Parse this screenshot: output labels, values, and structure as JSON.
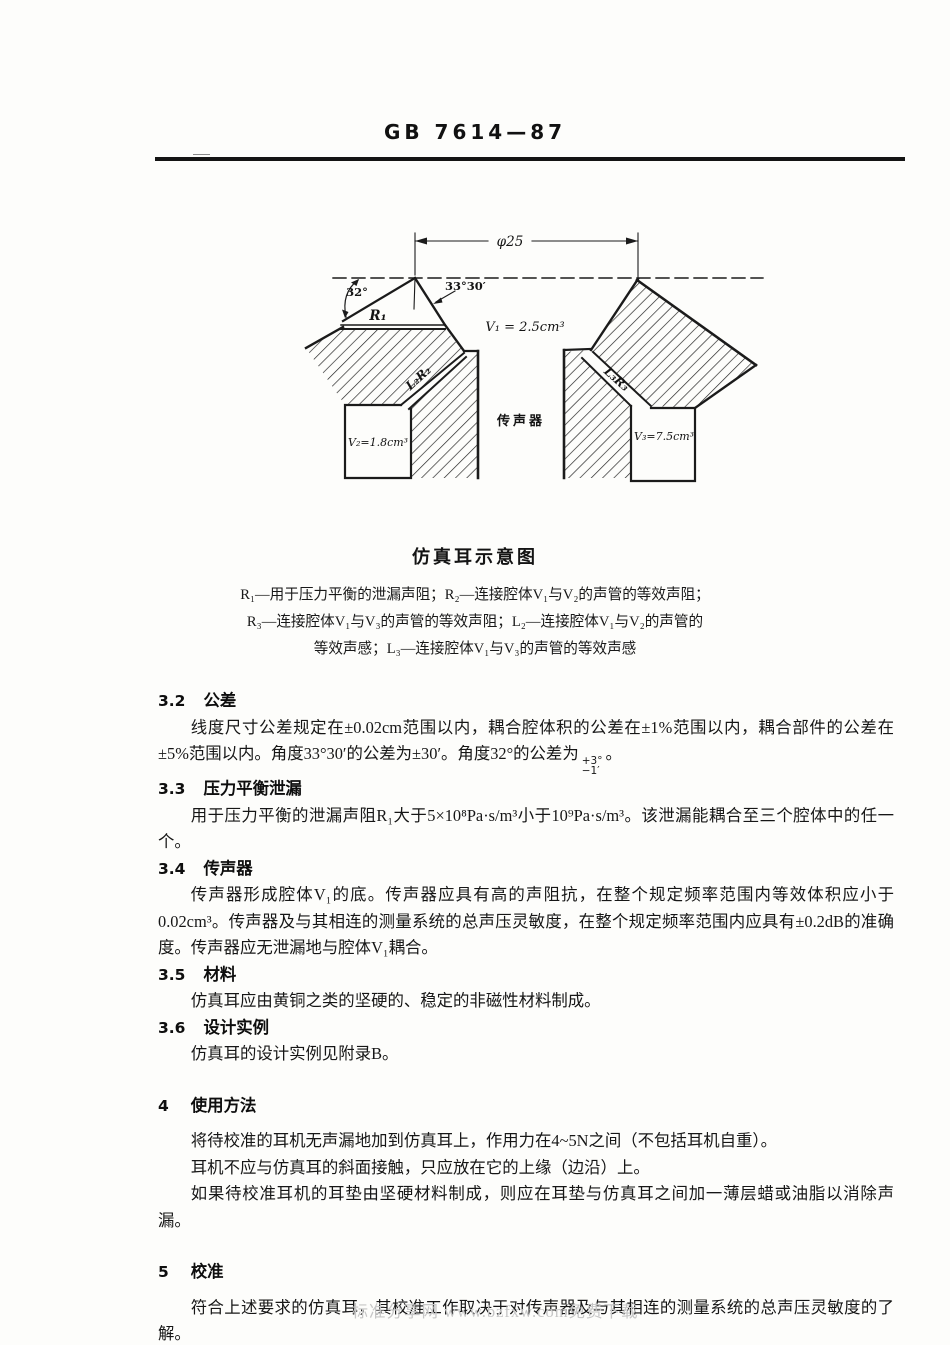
{
  "header": {
    "standard_no": "GB 7614—87"
  },
  "colors": {
    "paper": "#fdfdfb",
    "ink": "#1c1c1c",
    "watermark": "#c6c6c6"
  },
  "figure": {
    "caption": "仿真耳示意图",
    "dim_label": "φ25",
    "angle_left": "32°",
    "angle_right": "33°30′",
    "leak_label": "R₁",
    "cavity1_label": "V₁ = 2.5cm³",
    "cavity2_label": "V₂=1.8cm³",
    "cavity3_label": "V₃=7.5cm³",
    "duct_left_label": "L₂R₂",
    "duct_right_label": "L₃R₃",
    "mic_label": "传声器",
    "legend": [
      "R₁—用于压力平衡的泄漏声阻；R₂—连接腔体V₁与V₂的声管的等效声阻；",
      "R₃—连接腔体V₁与V₃的声管的等效声阻；L₂—连接腔体V₁与V₂的声管的",
      "等效声感；L₃—连接腔体V₁与V₃的声管的等效声感"
    ]
  },
  "content": {
    "s32": {
      "num": "3.2",
      "title": "公差",
      "p1a": "线度尺寸公差规定在±0.02cm范围以内，耦合腔体积的公差在±1%范围以内，耦合部件的公差在±5%范围以内。角度33°30′的公差为±30′。角度32°的公差为",
      "tol_top": "+3°",
      "tol_bottom": "−1′",
      "p1b": "。"
    },
    "s33": {
      "num": "3.3",
      "title": "压力平衡泄漏",
      "p1": "用于压力平衡的泄漏声阻R₁大于5×10⁸Pa·s/m³小于10⁹Pa·s/m³。该泄漏能耦合至三个腔体中的任一个。"
    },
    "s34": {
      "num": "3.4",
      "title": "传声器",
      "p1": "传声器形成腔体V₁的底。传声器应具有高的声阻抗，在整个规定频率范围内等效体积应小于0.02cm³。传声器及与其相连的测量系统的总声压灵敏度，在整个规定频率范围内应具有±0.2dB的准确度。传声器应无泄漏地与腔体V₁耦合。"
    },
    "s35": {
      "num": "3.5",
      "title": "材料",
      "p1": "仿真耳应由黄铜之类的坚硬的、稳定的非磁性材料制成。"
    },
    "s36": {
      "num": "3.6",
      "title": "设计实例",
      "p1": "仿真耳的设计实例见附录B。"
    },
    "s4": {
      "num": "4",
      "title": "使用方法",
      "p1": "将待校准的耳机无声漏地加到仿真耳上，作用力在4~5N之间（不包括耳机自重）。",
      "p2": "耳机不应与仿真耳的斜面接触，只应放在它的上缘（边沿）上。",
      "p3": "如果待校准耳机的耳垫由坚硬材料制成，则应在耳垫与仿真耳之间加一薄层蜡或油脂以消除声漏。"
    },
    "s5": {
      "num": "5",
      "title": "校准",
      "p1": "符合上述要求的仿真耳，其校准工作取决于对传声器及与其相连的测量系统的总声压灵敏度的了解。",
      "p2": "建议生产符合本标准规定的仿真耳的制造厂在说明书中叙述确定总稳定性的方法。"
    }
  },
  "footer": {
    "watermark": "标准分享网 www.bzfxw.com免费下载"
  }
}
